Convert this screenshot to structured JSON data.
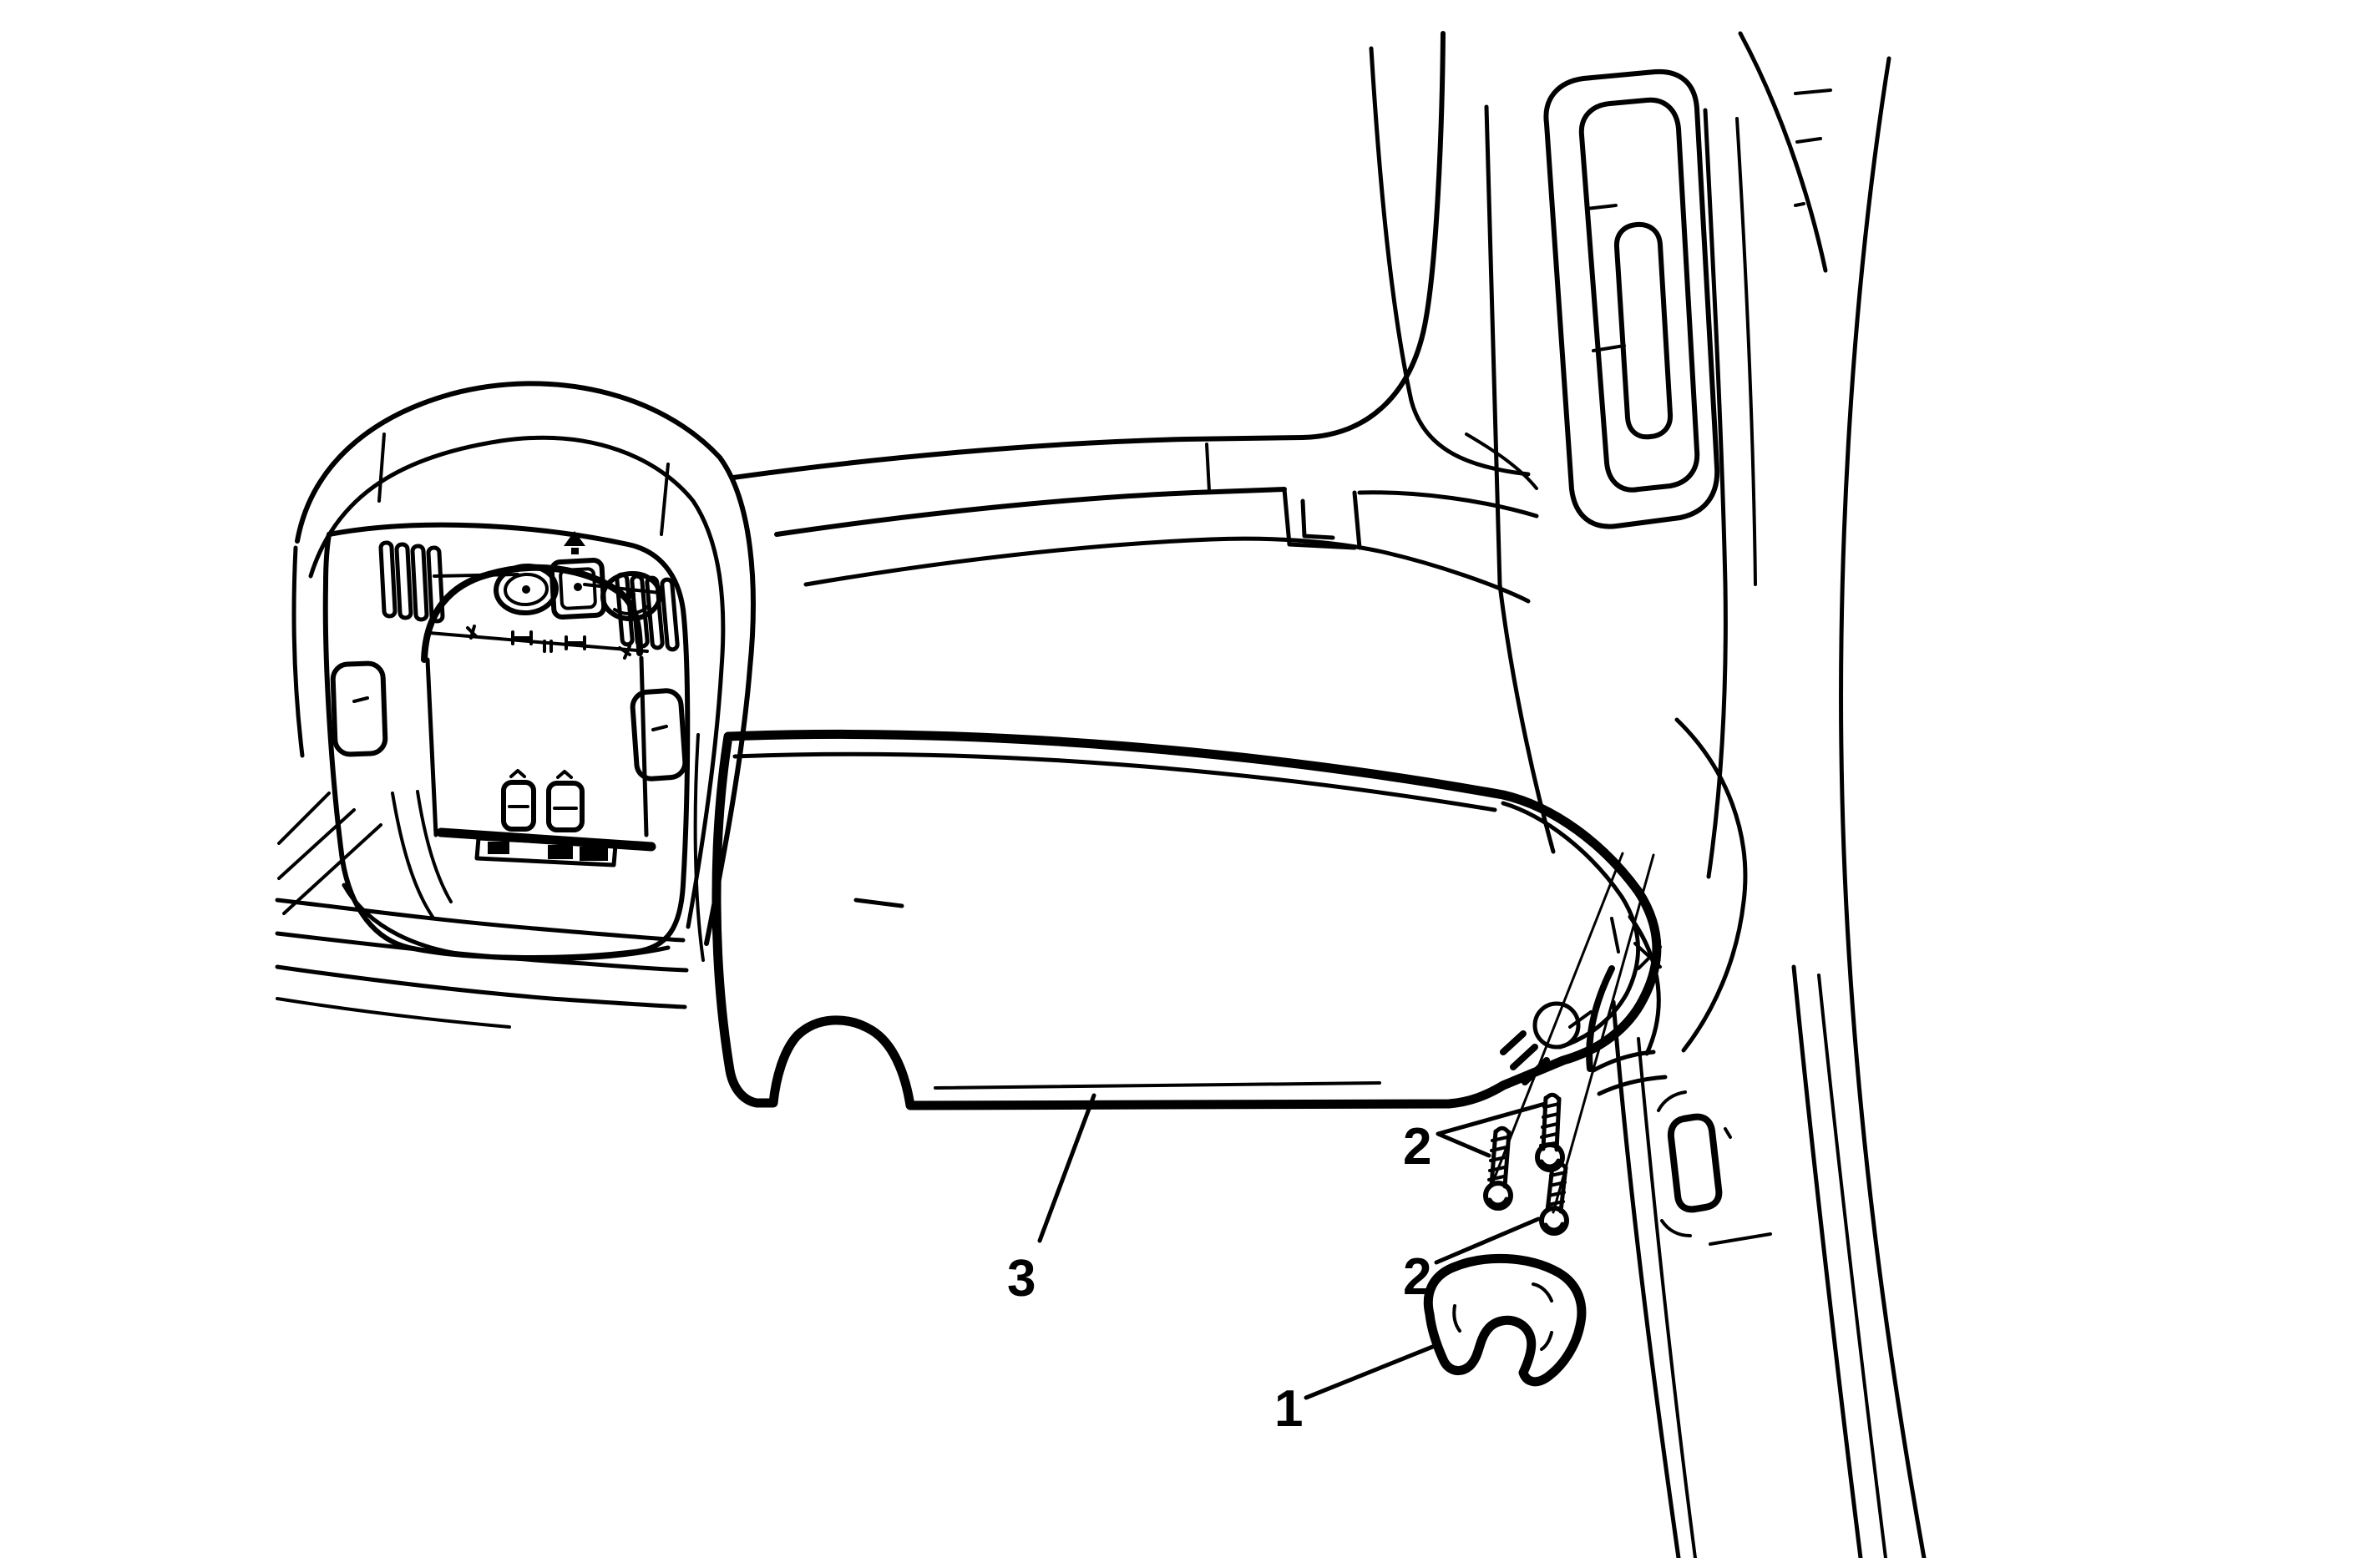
{
  "figure": {
    "background_color": "#ffffff",
    "line_color": "#000000"
  },
  "callouts": {
    "clip": "1",
    "screws_upper": "2",
    "screws_lower": "2",
    "sunshade": "3"
  }
}
